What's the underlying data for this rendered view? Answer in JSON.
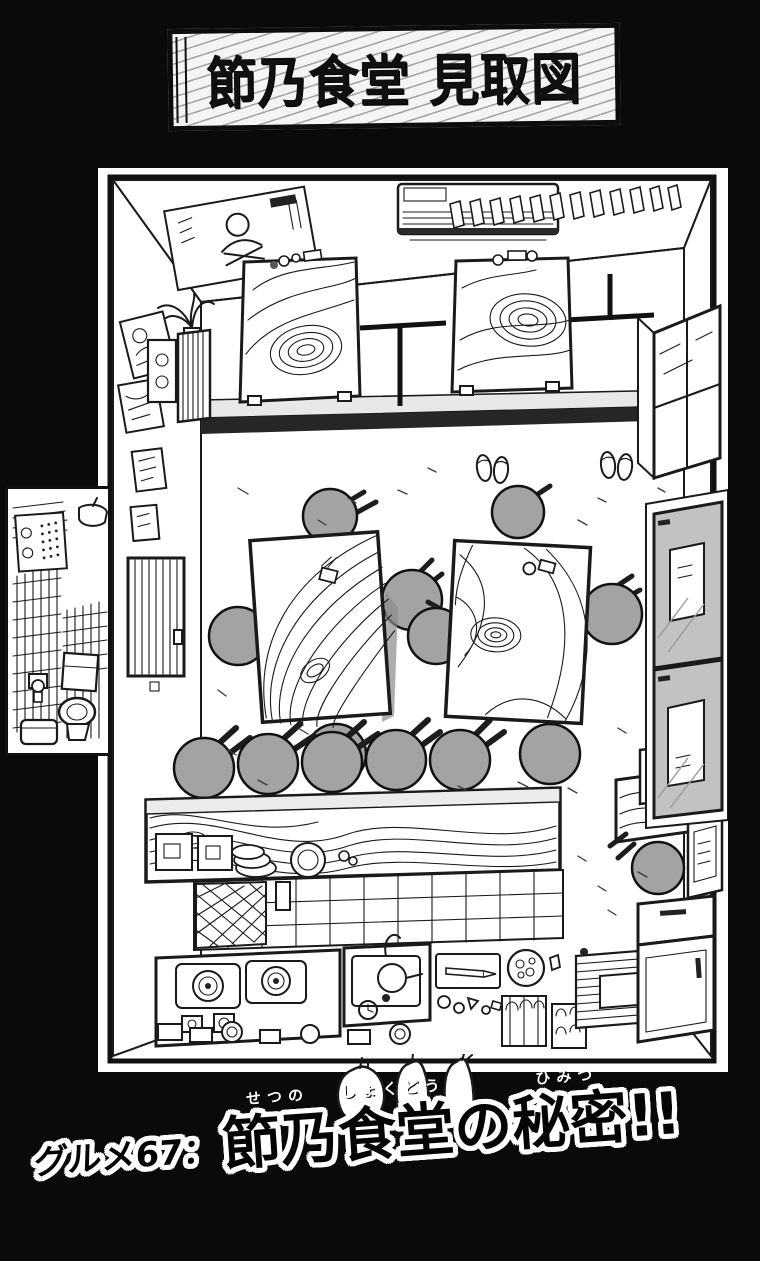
{
  "signboard": {
    "title": "節乃食堂 見取図"
  },
  "caption": {
    "prefix": "グルメ67：",
    "segments": [
      {
        "base": "節乃",
        "ruby": "せつの"
      },
      {
        "base": "食堂",
        "ruby": "しょくどう"
      },
      {
        "base": "の",
        "ruby": ""
      },
      {
        "base": "秘密",
        "ruby": "ひみつ"
      },
      {
        "base": "!!",
        "ruby": ""
      }
    ]
  },
  "colors": {
    "page_background": "#0a0a0a",
    "paper": "#ffffff",
    "ink": "#1a1a1a",
    "stool_gray": "#a3a3a3",
    "door_gray": "#c2c2c2",
    "step_dark": "#262626"
  }
}
